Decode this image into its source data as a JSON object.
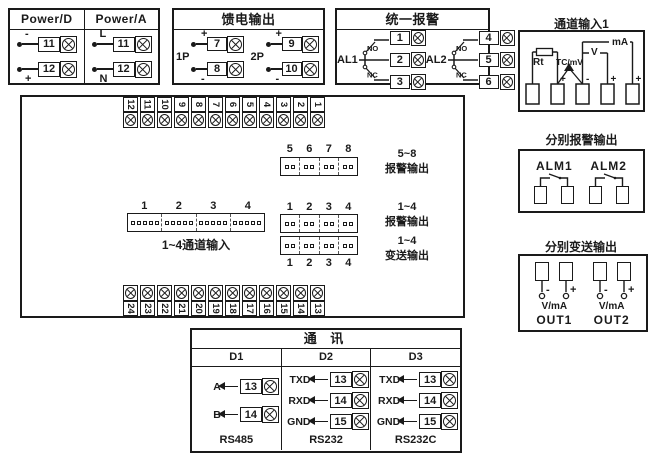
{
  "power": {
    "d": {
      "title": "Power/D",
      "rows": [
        {
          "sign": "-",
          "num": "11"
        },
        {
          "sign": "+",
          "num": "12"
        }
      ]
    },
    "a": {
      "title": "Power/A",
      "rows": [
        {
          "sign": "L",
          "num": "11"
        },
        {
          "sign": "N",
          "num": "12"
        }
      ]
    }
  },
  "feed": {
    "title": "馈电输出",
    "groups": [
      {
        "label": "1P",
        "rows": [
          {
            "sign": "+",
            "num": "7"
          },
          {
            "sign": "-",
            "num": "8"
          }
        ]
      },
      {
        "label": "2P",
        "rows": [
          {
            "sign": "+",
            "num": "9"
          },
          {
            "sign": "-",
            "num": "10"
          }
        ]
      }
    ]
  },
  "unified_alarm": {
    "title": "统一报警",
    "groups": [
      {
        "label": "AL1",
        "no": "NO",
        "nc": "NC",
        "terms": [
          "1",
          "2",
          "3"
        ]
      },
      {
        "label": "AL2",
        "no": "NO",
        "nc": "NC",
        "terms": [
          "4",
          "5",
          "6"
        ]
      }
    ]
  },
  "main_board": {
    "top_terminals": [
      "12",
      "11",
      "10",
      "9",
      "8",
      "7",
      "6",
      "5",
      "4",
      "3",
      "2",
      "1"
    ],
    "bottom_terminals": [
      "24",
      "23",
      "22",
      "21",
      "20",
      "19",
      "18",
      "17",
      "16",
      "15",
      "14",
      "13"
    ],
    "alarm58": {
      "pins": [
        "5",
        "6",
        "7",
        "8"
      ],
      "range": "5~8",
      "name": "报警输出"
    },
    "channel": {
      "pins": [
        "1",
        "2",
        "3",
        "4"
      ],
      "label": "1~4通道输入"
    },
    "alarm14": {
      "pins": [
        "1",
        "2",
        "3",
        "4"
      ],
      "range": "1~4",
      "name": "报警输出"
    },
    "trans14": {
      "pins": [
        "1",
        "2",
        "3",
        "4"
      ],
      "range": "1~4",
      "name": "变送输出"
    }
  },
  "comm": {
    "title": "通 讯",
    "columns": [
      {
        "header": "D1",
        "rows": [
          {
            "label": "A",
            "num": "13"
          },
          {
            "label": "B",
            "num": "14"
          }
        ],
        "footer": "RS485"
      },
      {
        "header": "D2",
        "rows": [
          {
            "label": "TXD",
            "num": "13"
          },
          {
            "label": "RXD",
            "num": "14"
          },
          {
            "label": "GND",
            "num": "15"
          }
        ],
        "footer": "RS232"
      },
      {
        "header": "D3",
        "rows": [
          {
            "label": "TXD",
            "num": "13"
          },
          {
            "label": "RXD",
            "num": "14"
          },
          {
            "label": "GND",
            "num": "15"
          }
        ],
        "footer": "RS232C"
      }
    ]
  },
  "channel_input": {
    "title": "通道输入1",
    "rt": "Rt",
    "tc": "TC/mV",
    "v": "V",
    "ma": "mA",
    "signs": [
      "+",
      "-",
      "+",
      "+"
    ]
  },
  "alarm_output": {
    "title": "分别报警输出",
    "items": [
      "ALM1",
      "ALM2"
    ]
  },
  "trans_output": {
    "title": "分别变送输出",
    "groups": [
      {
        "minus": "-",
        "plus": "+",
        "unit": "V/mA",
        "label": "OUT1"
      },
      {
        "minus": "-",
        "plus": "+",
        "unit": "V/mA",
        "label": "OUT2"
      }
    ]
  }
}
